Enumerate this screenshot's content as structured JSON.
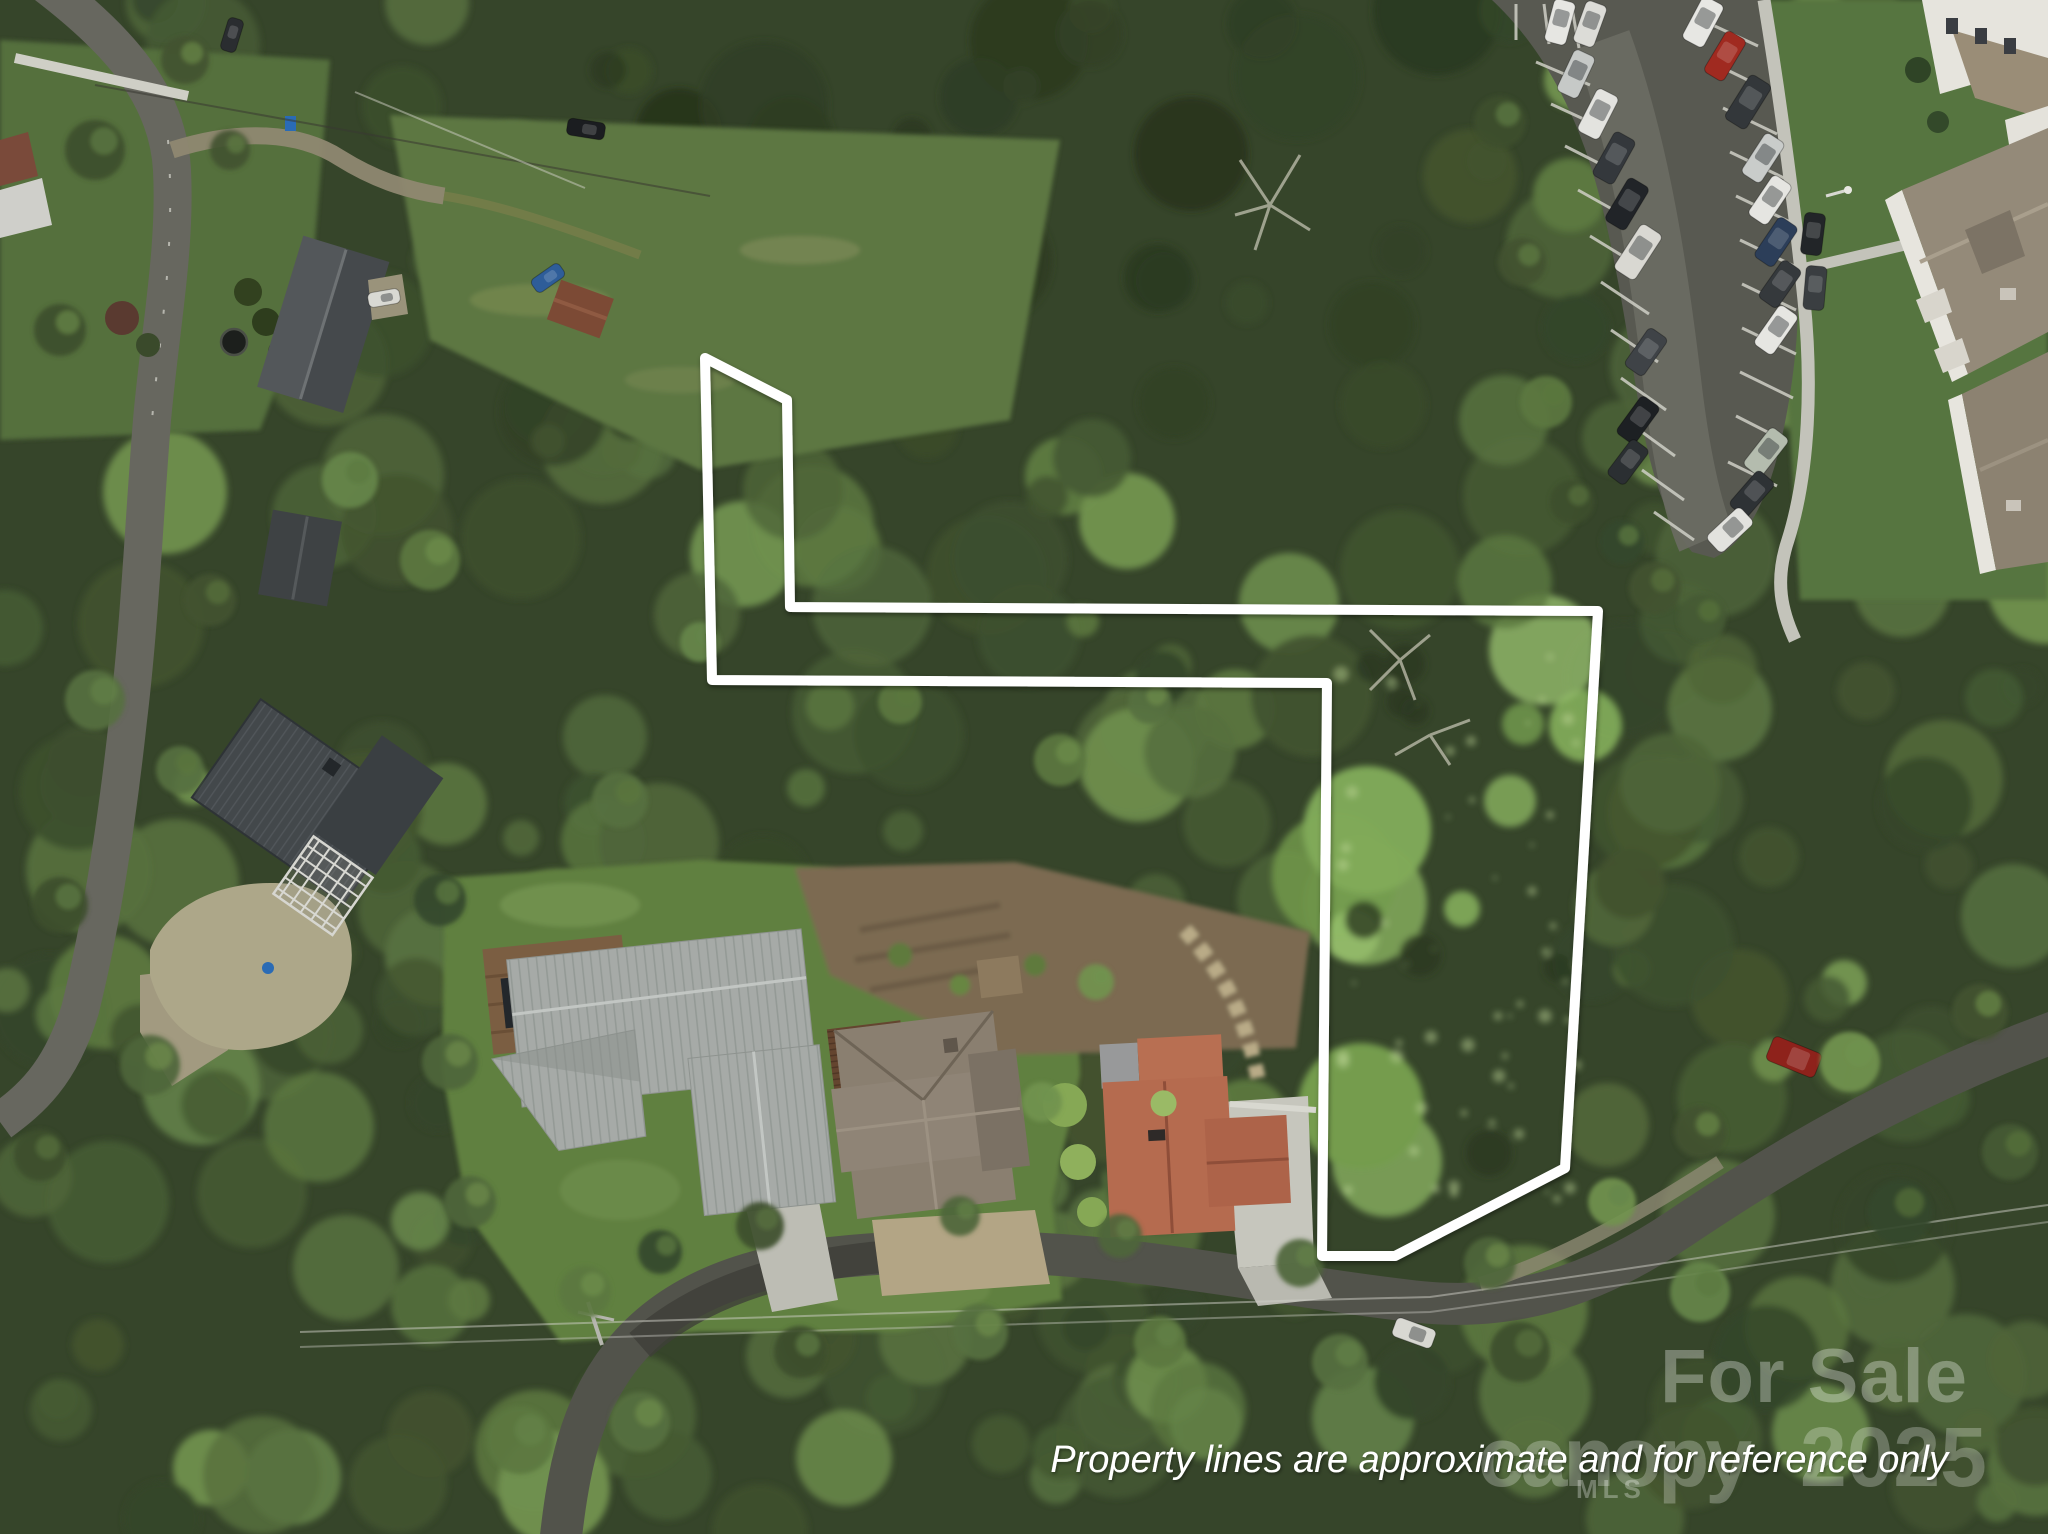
{
  "overlay": {
    "disclaimer": "Property lines are approximate and for reference only",
    "watermark_for_sale": "For Sale",
    "watermark_brand": "canopy",
    "watermark_brand_sub": "MLS",
    "watermark_year": "2025"
  },
  "colors": {
    "property_line": "#ffffff",
    "watermark_text": "#ffffff",
    "forest_dark": "#2e3b22",
    "forest_bright": "#8ab163",
    "road_asphalt": "#55564e",
    "parking_asphalt": "#5a5b53",
    "concrete": "#c0c0b8",
    "gravel": "#a89f83",
    "metal_roof": "#a6aaa7",
    "shingle_roof": "#8a7f70",
    "terracotta_roof": "#b56b4f",
    "modern_house_roof": "#43484b"
  }
}
